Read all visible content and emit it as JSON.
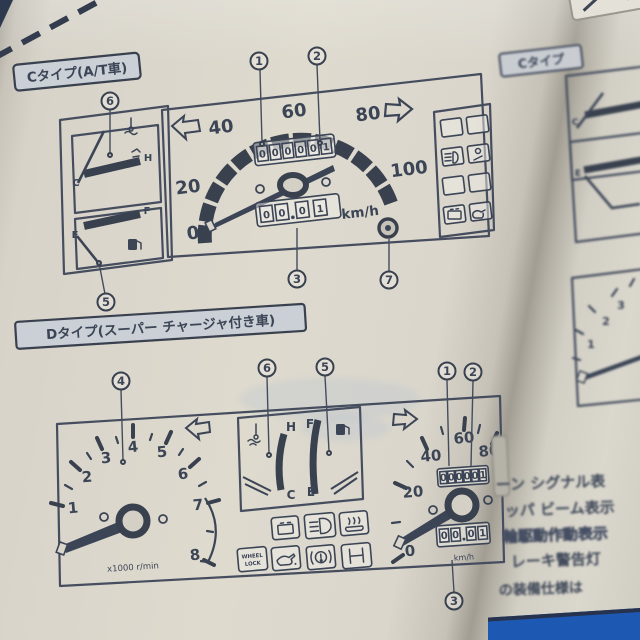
{
  "colors": {
    "ink": "#3c4556",
    "paper": "#d9d5cb",
    "label_fill": "#cbd0d6",
    "blue_corner": "#1d58b3"
  },
  "left_page": {
    "c_section": {
      "label": "Cタイプ(A/T車)",
      "callout_1": "1",
      "callout_2": "2",
      "callout_3": "3",
      "callout_5": "5",
      "callout_6": "6",
      "callout_7": "7",
      "temp_gauge": {
        "low": "C",
        "high": "H"
      },
      "fuel_gauge": {
        "low": "E",
        "high": "F"
      },
      "speedometer": {
        "t0": "0",
        "t20": "20",
        "t40": "40",
        "t60": "60",
        "t80": "80",
        "t100": "100",
        "unit": "km/h"
      },
      "odometer_digits": [
        "0",
        "0",
        "0",
        "0",
        "0",
        "1"
      ],
      "trip_digits": [
        "0",
        "0",
        "0",
        "1"
      ]
    },
    "d_section": {
      "label": "Dタイプ(スーパー チャージャ付き車)",
      "callout_1": "1",
      "callout_2": "2",
      "callout_3": "3",
      "callout_4": "4",
      "callout_5": "5",
      "callout_6": "6",
      "tachometer": {
        "n1": "1",
        "n2": "2",
        "n3": "3",
        "n4": "4",
        "n5": "5",
        "n6": "6",
        "n7": "7",
        "n8": "8",
        "unit": "x1000 r/min"
      },
      "temp_gauge": {
        "low": "C",
        "high": "H"
      },
      "fuel_gauge": {
        "low": "E",
        "high": "F"
      },
      "wheel_lock": {
        "line1": "WHEEL",
        "line2": "LOCK"
      },
      "speedometer": {
        "t0": "0",
        "t20": "20",
        "t40": "40",
        "t60": "60",
        "t80": "80",
        "unit": "km/h"
      },
      "odometer_digits": [
        "0",
        "0",
        "0",
        "0",
        "0",
        "1"
      ],
      "trip_digits": [
        "0",
        "0",
        "0",
        "1"
      ]
    }
  },
  "right_page": {
    "c_label": "Cタイプ",
    "tach": {
      "n1": "1",
      "n2": "2",
      "n3": "3"
    },
    "text_lines": [
      "ーン シグナル表",
      "ッパ ビーム表示",
      "輪駆動作動表示",
      "レーキ警告灯",
      "の装備仕様は"
    ]
  }
}
